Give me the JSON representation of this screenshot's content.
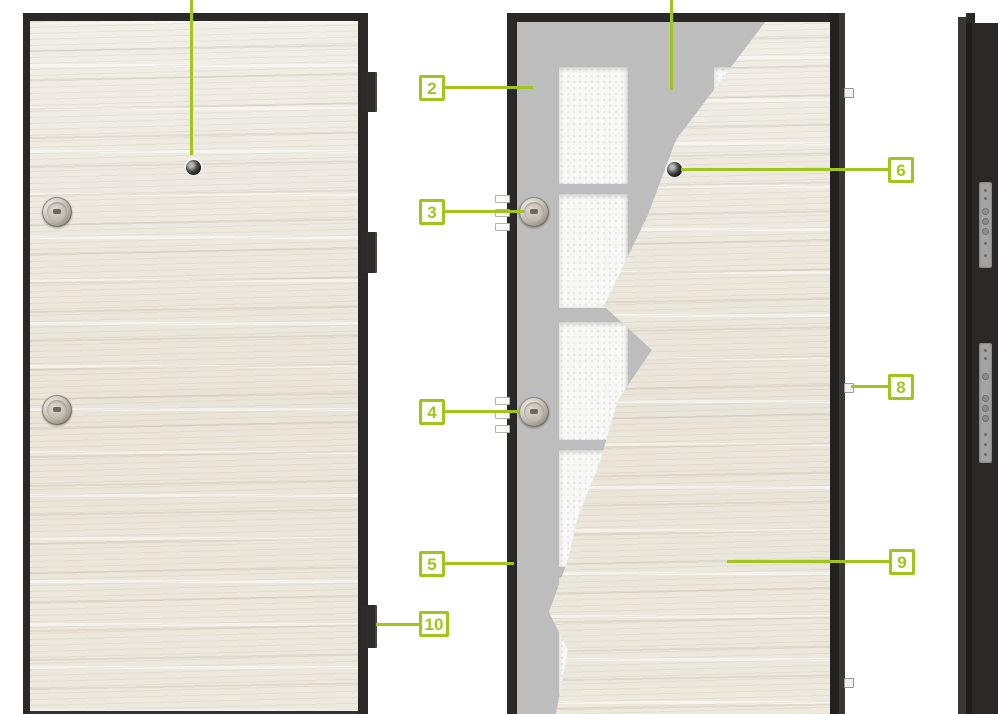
{
  "diagram": {
    "kind": "entrance-door-construction-cutaway",
    "accent_color": "#a2c51d",
    "frame_color": "#2b2927",
    "steel_color": "#bdbdbd",
    "foam_color": "#f6f6f6",
    "wood_color": "#ece8de"
  },
  "callouts": {
    "c2": "2",
    "c3": "3",
    "c4": "4",
    "c5": "5",
    "c6": "6",
    "c8": "8",
    "c9": "9",
    "c10": "10"
  }
}
